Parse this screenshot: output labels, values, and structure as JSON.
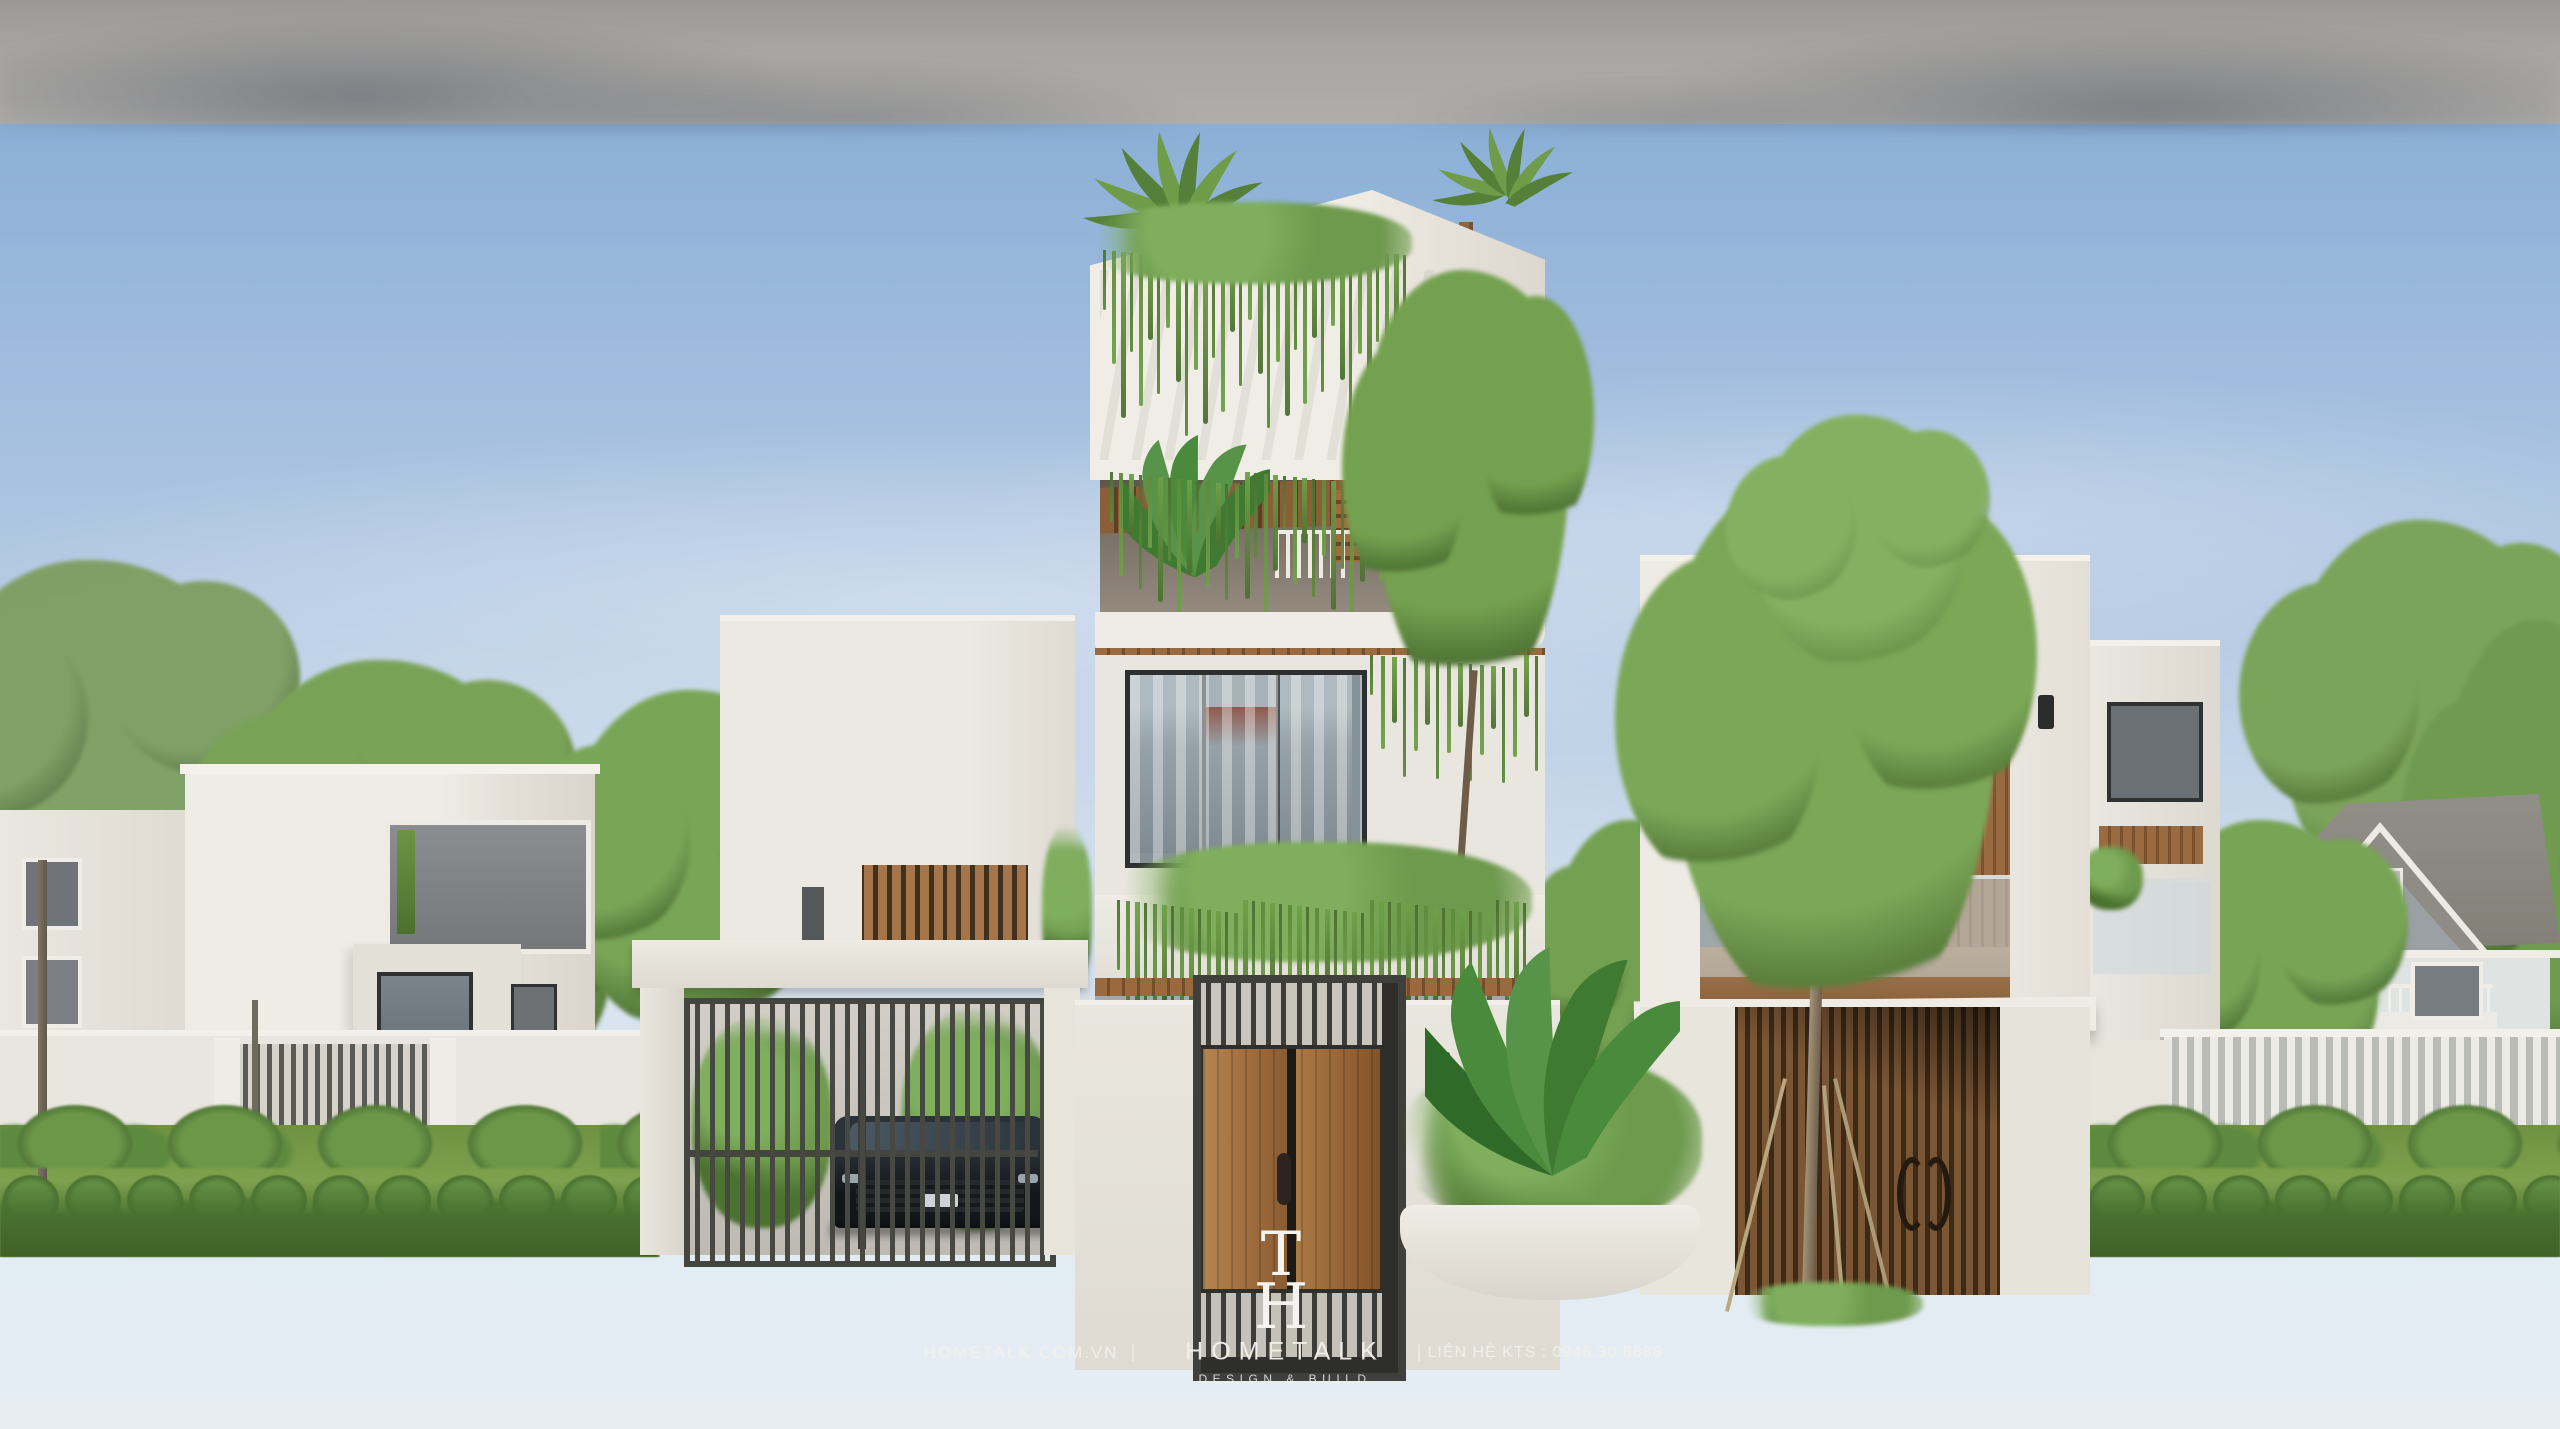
{
  "canvas": {
    "width": 2560,
    "height": 1429
  },
  "watermark": {
    "site": "HOMETALK.COM.VN",
    "divider_left": "|",
    "divider_right": "|",
    "brand": "HOMETALK",
    "tagline": "DESIGN & BUILD",
    "contact": "LIÊN HỆ KTS : 0946.30.8888",
    "logo": {
      "letter_top": "T",
      "letter_bottom": "H"
    },
    "text_color": "#f2f1ec"
  },
  "palette": {
    "sky_top": "#7fa6d1",
    "sky_mid": "#bed1e6",
    "sky_horizon": "#e6eef4",
    "wall_light": "#edeae3",
    "wall_shade": "#d9d5cd",
    "concrete": "#e4e1d9",
    "wood_light": "#b5854f",
    "wood_mid": "#9a6a3e",
    "wood_dark": "#6b4a2c",
    "metal_dark": "#43443e",
    "leaf_light": "#8aab5a",
    "leaf_mid": "#6d9444",
    "leaf_dark": "#4c7030",
    "lawn": "#80a250",
    "hedge": "#577f3a",
    "road": "#a6a4a0",
    "sidewalk": "#dfdcd4",
    "roof_gray": "#8f8d86",
    "shadow_blue": "rgba(60,72,90,0.38)"
  }
}
